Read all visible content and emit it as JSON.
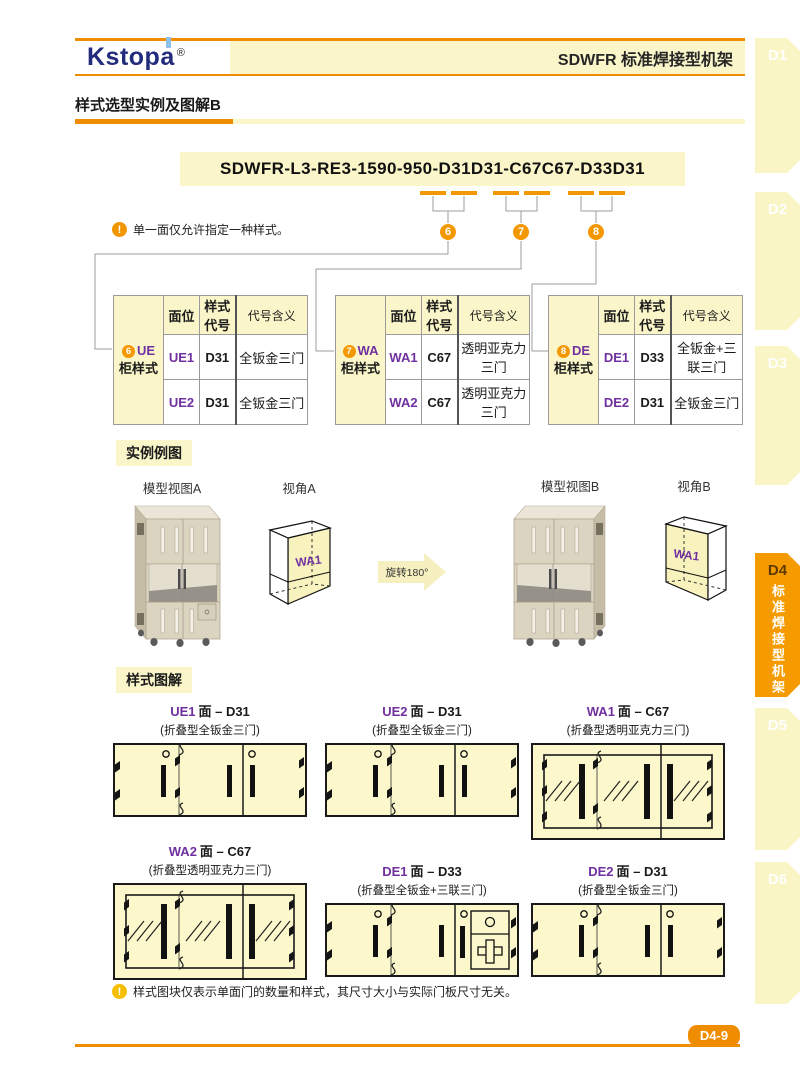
{
  "colors": {
    "accent_orange": "#F39800",
    "line_orange": "#F08C00",
    "pale_yellow": "#FBF6C9",
    "purple": "#7030A0",
    "logo_navy": "#232C7C"
  },
  "logo": {
    "text": "Kstopa",
    "reg": "®"
  },
  "header": {
    "title": "SDWFR 标准焊接型机架"
  },
  "section": {
    "title": "样式选型实例及图解B"
  },
  "code": {
    "value": "SDWFR-L3-RE3-1590-950-D31D31-C67C67-D33D31",
    "callouts": [
      "6",
      "7",
      "8"
    ]
  },
  "notes": {
    "icon": "!",
    "top": "单一面仅允许指定一种样式。",
    "bottom": "样式图块仅表示单面门的数量和样式，其尺寸大小与实际门板尺寸无关。"
  },
  "tables": [
    {
      "num": "6",
      "code": "UE",
      "name": "柜样式",
      "headers": [
        "面位",
        "样式代号",
        "代号含义"
      ],
      "rows": [
        [
          "UE1",
          "D31",
          "全钣金三门"
        ],
        [
          "UE2",
          "D31",
          "全钣金三门"
        ]
      ]
    },
    {
      "num": "7",
      "code": "WA",
      "name": "柜样式",
      "headers": [
        "面位",
        "样式代号",
        "代号含义"
      ],
      "rows": [
        [
          "WA1",
          "C67",
          "透明亚克力三门"
        ],
        [
          "WA2",
          "C67",
          "透明亚克力三门"
        ]
      ]
    },
    {
      "num": "8",
      "code": "DE",
      "name": "柜样式",
      "headers": [
        "面位",
        "样式代号",
        "代号含义"
      ],
      "rows": [
        [
          "DE1",
          "D33",
          "全钣金+三联三门"
        ],
        [
          "DE2",
          "D31",
          "全钣金三门"
        ]
      ]
    }
  ],
  "example": {
    "label": "实例例图",
    "model_a": "模型视图A",
    "angle_a": "视角A",
    "model_b": "模型视图B",
    "angle_b": "视角B",
    "rotate": "旋转180°",
    "face": "WA1"
  },
  "diagrams": {
    "label": "样式图解",
    "panels": [
      {
        "face": "UE1",
        "tail": "面 – D31",
        "subtitle": "(折叠型全钣金三门)",
        "type": "D31"
      },
      {
        "face": "UE2",
        "tail": "面 – D31",
        "subtitle": "(折叠型全钣金三门)",
        "type": "D31"
      },
      {
        "face": "WA1",
        "tail": "面 – C67",
        "subtitle": "(折叠型透明亚克力三门)",
        "type": "C67"
      },
      {
        "face": "WA2",
        "tail": "面 – C67",
        "subtitle": "(折叠型透明亚克力三门)",
        "type": "C67"
      },
      {
        "face": "DE1",
        "tail": "面 – D33",
        "subtitle": "(折叠型全钣金+三联三门)",
        "type": "D33"
      },
      {
        "face": "DE2",
        "tail": "面 – D31",
        "subtitle": "(折叠型全钣金三门)",
        "type": "D31"
      }
    ]
  },
  "sidebar": {
    "tabs": [
      {
        "label": "D1"
      },
      {
        "label": "D2"
      },
      {
        "label": "D3"
      },
      {
        "label": "D4",
        "sub": "标准焊接型机架",
        "active": true
      },
      {
        "label": "D5"
      },
      {
        "label": "D6"
      }
    ]
  },
  "footer": {
    "page": "D4-9"
  }
}
